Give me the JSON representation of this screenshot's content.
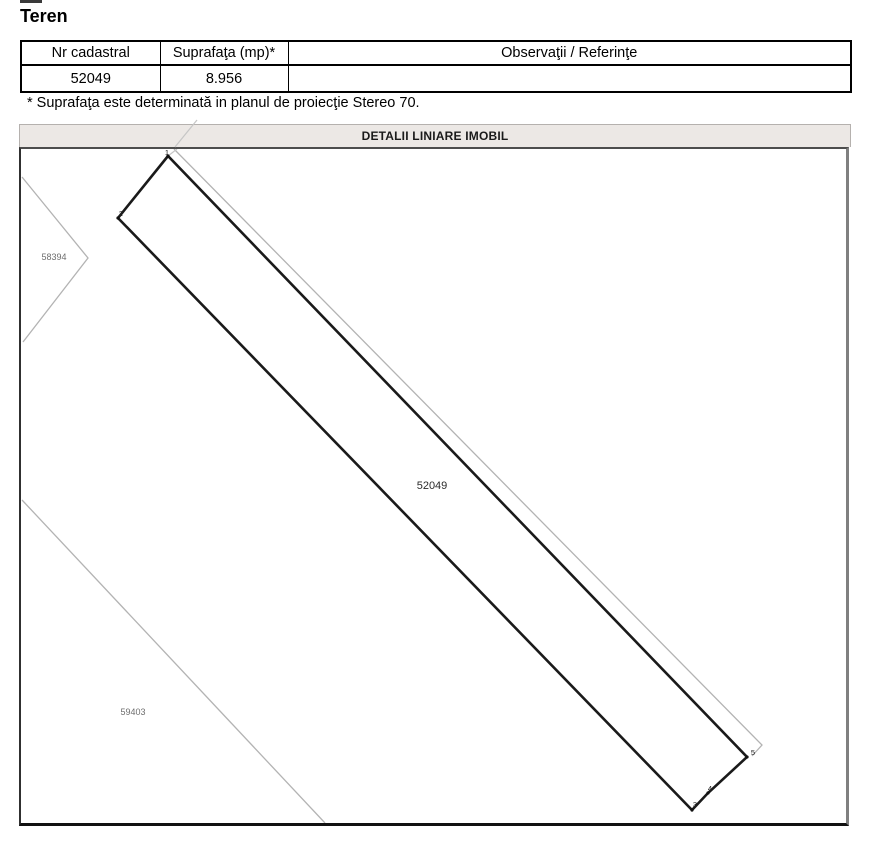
{
  "page": {
    "title": "Teren"
  },
  "table": {
    "columns": [
      "Nr cadastral",
      "Suprafaţa (mp)*",
      "Observaţii / Referinţe"
    ],
    "rows": [
      {
        "nr_cadastral": "52049",
        "suprafata": "8.956",
        "observatii": ""
      }
    ]
  },
  "footnote": "* Suprafaţa este determinată in planul de proiecţie Stereo 70.",
  "map": {
    "section_title": "DETALII LINIARE IMOBIL",
    "parcel_label": "52049",
    "neighbor_parcels": [
      {
        "label": "58394"
      },
      {
        "label": "59403"
      }
    ],
    "vertex_labels": [
      "1",
      "2",
      "3",
      "4",
      "5"
    ],
    "colors": {
      "parcel_boundary": "#1a1a1a",
      "neighbor_line": "#b3b3b3",
      "faint_extension_line": "#c6c6c6",
      "frame_right": "#808080",
      "frame_bottom": "#111111",
      "header_bar_bg": "#ece8e5"
    }
  }
}
